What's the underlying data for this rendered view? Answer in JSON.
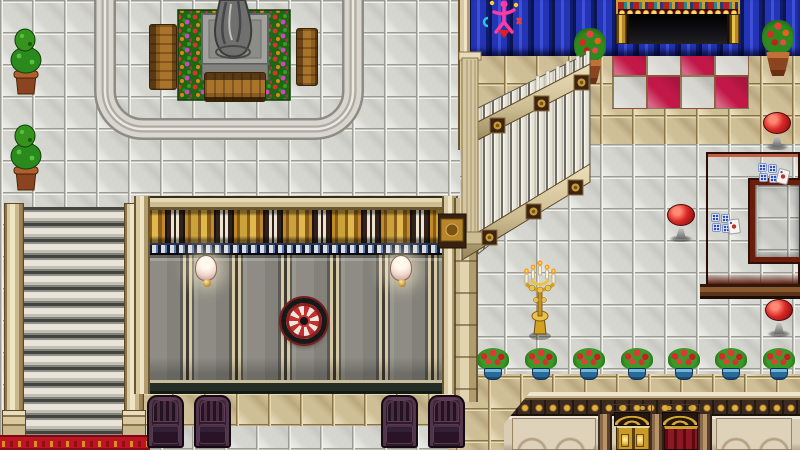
{
  "meta": {
    "scene_type": "top-down RPG interior map",
    "style": "casino / mansion hall",
    "viewport": "800x450",
    "tile_size_px": 32
  },
  "palette": {
    "floor_white": "#d6d6d1",
    "floor_tan": "#cfbf97",
    "checker_red": "#c21848",
    "curtain_blue": "#2334b4",
    "wall_panel_gray": "#8e8c84",
    "wall_gold": "#c49232",
    "wood": "#8a5c20",
    "carpet_red": "#bf1422",
    "table_maroon": "#9a3a20",
    "stool_red": "#d82826",
    "armchair_plum": "#342036",
    "gold": "#d8a830",
    "marble_trim": "#d9cdb5",
    "track_gray": "#d9d6ce",
    "garden_green": "#1d6812"
  },
  "objects": {
    "statue": {
      "label": "Stone statue on pedestal"
    },
    "garden": {
      "label": "Flower bed around statue"
    },
    "bench": {
      "label": "Wooden bench",
      "count": 3
    },
    "topiary": {
      "label": "Potted topiary plant",
      "count": 2
    },
    "track": {
      "label": "Walking path loop"
    },
    "stairs_down": {
      "label": "Staircase going down"
    },
    "carpet": {
      "label": "Red carpet"
    },
    "wall": {
      "label": "Panelled wall with gold frieze"
    },
    "sconce": {
      "label": "Shell wall lamp",
      "count": 2
    },
    "dartboard": {
      "label": "Dartboard"
    },
    "armchair": {
      "label": "Plum armchair",
      "count": 4
    },
    "grand_staircase": {
      "label": "Grand staircase"
    },
    "curtain": {
      "label": "Blue stage curtain"
    },
    "neon_sign": {
      "label": "Neon figure sign on curtain"
    },
    "marquee": {
      "label": "Lighted marquee booth"
    },
    "marquee_opening": {
      "label": "Dark booth doorway"
    },
    "checker_floor": {
      "label": "Red and white checker tiles"
    },
    "flower_pot_terracotta": {
      "label": "Terracotta pot with red flowers",
      "count": 2
    },
    "game_table": {
      "label": "Dice table with cards"
    },
    "dice_cluster": {
      "label": "Stacked blue-pip dice",
      "count": 2
    },
    "card": {
      "label": "Playing card",
      "count": 2
    },
    "stool": {
      "label": "Red round stool",
      "count": 3
    },
    "candelabra": {
      "label": "Gold candelabra"
    },
    "flower_pot_blue": {
      "label": "Blue pot with red flowers",
      "count": 7
    },
    "entrance": {
      "label": "Entrance hall lower wall"
    },
    "gold_door": {
      "label": "Golden double door"
    },
    "red_door": {
      "label": "Red curtained door"
    }
  }
}
